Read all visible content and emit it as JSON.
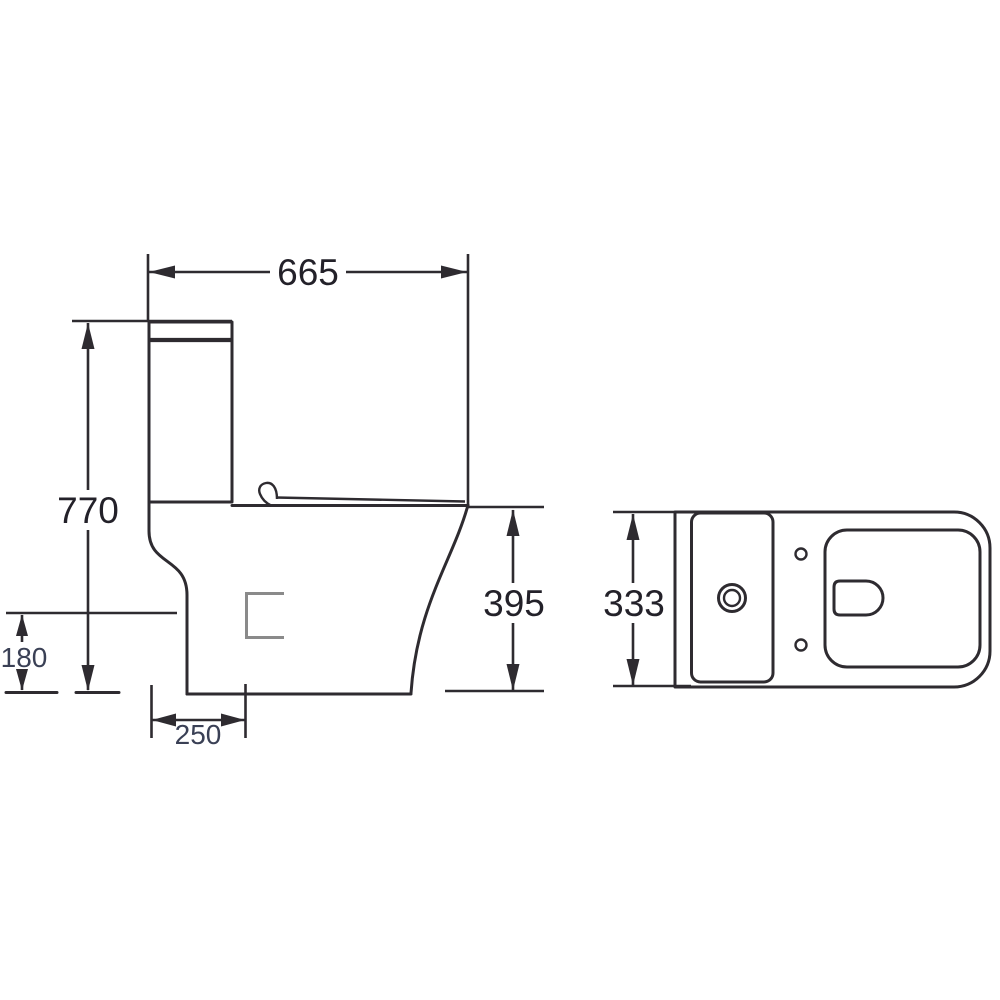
{
  "diagram": {
    "units": "mm",
    "side_view": {
      "dimensions": {
        "overall_depth": "665",
        "overall_height": "770",
        "pan_height": "395",
        "outlet_height": "180",
        "outlet_setout": "250"
      }
    },
    "plan_view": {
      "dimensions": {
        "overall_width": "333"
      }
    },
    "colors": {
      "line": "#2e2b30",
      "dim_text_large": "#232129",
      "dim_text_small": "#3a4055",
      "outlet_marker_gray": "#8a8a8a",
      "background": "#ffffff"
    }
  }
}
